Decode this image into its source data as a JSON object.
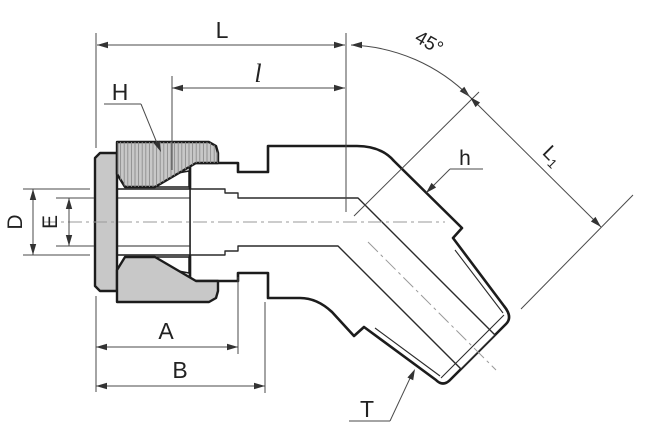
{
  "drawing": {
    "type": "technical-drawing",
    "subject": "45-degree male elbow tube fitting cross-section",
    "labels": {
      "overall_length": "L",
      "thread_engagement": "l",
      "bend_angle": "45°",
      "nut_hex": "H",
      "body_hex": "h",
      "branch_length_main": "L",
      "branch_length_sub": "1",
      "tube_od": "D",
      "bore_dia": "E",
      "dim_a": "A",
      "dim_b": "B",
      "thread": "T"
    },
    "colors": {
      "background": "#ffffff",
      "outline": "#1c1c1c",
      "nut_fill": "#c8c8c8",
      "body_fill": "#e4e4e4",
      "cavity_fill": "#ffffff",
      "hatch": "#8d8d8d",
      "dim_line": "#4a4a4a",
      "centerline": "#9a9a9a"
    }
  }
}
